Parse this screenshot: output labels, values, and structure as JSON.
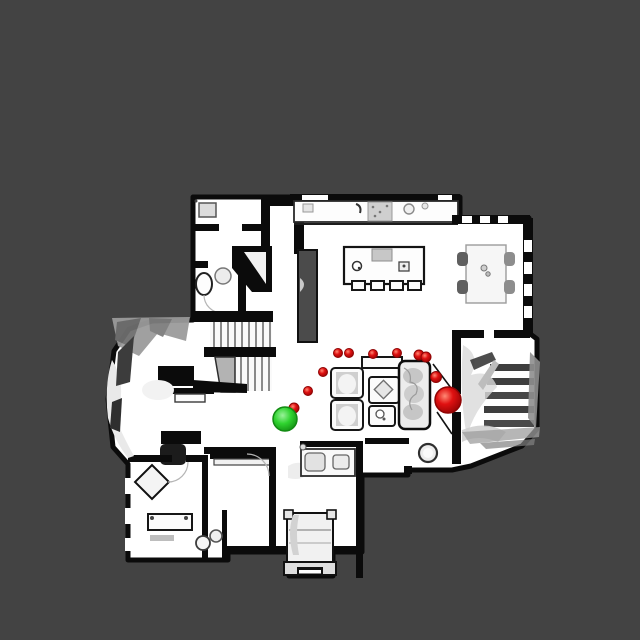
{
  "canvas": {
    "width": 640,
    "height": 640,
    "background_color": "#434343"
  },
  "floorplan": {
    "floor_color": "#ffffff",
    "wall_color": "#0b0b0b",
    "furniture_shade_color": "#c4c4c4",
    "artifact_color": "#969696"
  },
  "markers": {
    "green_sphere": {
      "name": "green-sphere-marker",
      "x": 285,
      "y": 419,
      "r": 12,
      "color": "#2fd32f",
      "highlight": "#94f094",
      "rim": "#128a12"
    },
    "large_red_sphere": {
      "name": "large-red-sphere-marker",
      "x": 448,
      "y": 400,
      "r": 13,
      "color": "#e01111",
      "highlight": "#ff7a66",
      "rim": "#8f0404"
    },
    "red_dot_color": "#e01111",
    "red_dots": [
      {
        "x": 338,
        "y": 353,
        "r": 4.5
      },
      {
        "x": 349,
        "y": 353,
        "r": 4.5
      },
      {
        "x": 373,
        "y": 354,
        "r": 4.5
      },
      {
        "x": 397,
        "y": 353,
        "r": 4.5
      },
      {
        "x": 419,
        "y": 355,
        "r": 5
      },
      {
        "x": 426,
        "y": 357,
        "r": 5
      },
      {
        "x": 323,
        "y": 372,
        "r": 4.5
      },
      {
        "x": 308,
        "y": 391,
        "r": 4.5
      },
      {
        "x": 294,
        "y": 408,
        "r": 5
      },
      {
        "x": 436,
        "y": 377,
        "r": 5.5
      }
    ]
  }
}
